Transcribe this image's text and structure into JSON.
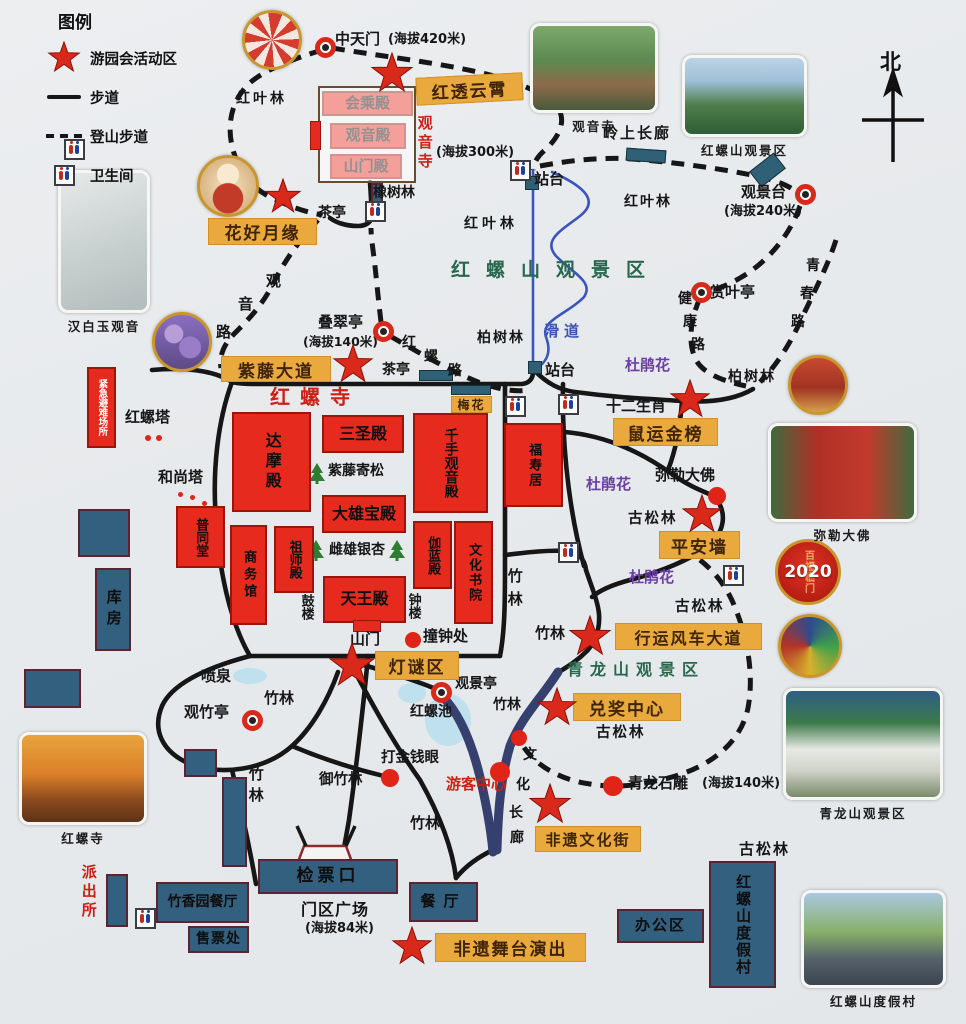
{
  "legend": {
    "title": "图例",
    "star_label": "游园会活动区",
    "walk_label": "步道",
    "trail_label": "登山步道",
    "toilet_label": "卫生间"
  },
  "compass": {
    "label": "北"
  },
  "badge": {
    "year": "2020",
    "motto": "百福临门"
  },
  "texts": [
    {
      "t": "中天门",
      "x": 335,
      "y": 32,
      "s": 15,
      "n": "label-zhongtianmen"
    },
    {
      "t": "(海拔420米)",
      "x": 388,
      "y": 33,
      "s": 13,
      "n": "label-elevation-420"
    },
    {
      "t": "红叶林",
      "x": 236,
      "y": 92,
      "sp": 3
    },
    {
      "t": "橡树林",
      "x": 373,
      "y": 186
    },
    {
      "t": "茶亭",
      "x": 318,
      "y": 206
    },
    {
      "t": "(海拔300米)",
      "x": 436,
      "y": 146,
      "s": 13,
      "n": "label-elevation-300"
    },
    {
      "t": "站台",
      "x": 534,
      "y": 172,
      "s": 15
    },
    {
      "t": "观音寺",
      "x": 416,
      "y": 115,
      "c": "red",
      "v": 1,
      "s": 15,
      "sp": 4,
      "n": "label-guanyin-temple"
    },
    {
      "t": "岭上长廊",
      "x": 603,
      "y": 126,
      "s": 15,
      "sp": 2,
      "n": "label-ridge-corridor"
    },
    {
      "t": "红叶林",
      "x": 624,
      "y": 195,
      "sp": 2
    },
    {
      "t": "红叶林",
      "x": 464,
      "y": 217,
      "sp": 4
    },
    {
      "t": "观景台",
      "x": 741,
      "y": 185,
      "s": 15,
      "n": "label-viewing-platform"
    },
    {
      "t": "(海拔240米)",
      "x": 724,
      "y": 205,
      "s": 13,
      "n": "label-elevation-240"
    },
    {
      "t": "赏叶亭",
      "x": 710,
      "y": 285,
      "s": 15
    },
    {
      "t": "健",
      "x": 678,
      "y": 292
    },
    {
      "t": "康",
      "x": 683,
      "y": 315
    },
    {
      "t": "路",
      "x": 691,
      "y": 338
    },
    {
      "t": "青",
      "x": 806,
      "y": 259
    },
    {
      "t": "春",
      "x": 800,
      "y": 287
    },
    {
      "t": "路",
      "x": 791,
      "y": 315
    },
    {
      "t": "柏树林",
      "x": 728,
      "y": 370,
      "sp": 2
    },
    {
      "t": "叠翠亭",
      "x": 318,
      "y": 315,
      "s": 15
    },
    {
      "t": "(海拔140米)",
      "x": 303,
      "y": 335,
      "s": 12.5,
      "n": "label-elevation-140"
    },
    {
      "t": "红",
      "x": 402,
      "y": 336
    },
    {
      "t": "螺",
      "x": 424,
      "y": 350
    },
    {
      "t": "路",
      "x": 448,
      "y": 364
    },
    {
      "t": "茶亭",
      "x": 382,
      "y": 363
    },
    {
      "t": "柏树林",
      "x": 477,
      "y": 331,
      "sp": 2
    },
    {
      "t": "站台",
      "x": 545,
      "y": 363,
      "s": 15
    },
    {
      "t": "滑道",
      "x": 544,
      "y": 324,
      "c": "blue",
      "s": 15,
      "sp": 5,
      "n": "label-slideway"
    },
    {
      "t": "红螺山观景区",
      "x": 451,
      "y": 261,
      "c": "green",
      "s": 19,
      "sp": 16,
      "n": "label-hongluoshan-scenic-area"
    },
    {
      "t": "杜鹃花",
      "x": 625,
      "y": 358,
      "c": "purple",
      "s": 15
    },
    {
      "t": "杜鹃花",
      "x": 586,
      "y": 477,
      "c": "purple",
      "s": 15
    },
    {
      "t": "杜鹃花",
      "x": 629,
      "y": 570,
      "c": "purple",
      "s": 15
    },
    {
      "t": "十二生肖",
      "x": 606,
      "y": 399,
      "s": 15,
      "n": "label-zodiac"
    },
    {
      "t": "弥勒大佛",
      "x": 655,
      "y": 468,
      "s": 15,
      "n": "label-maitreya"
    },
    {
      "t": "古松林",
      "x": 628,
      "y": 512,
      "s": 14.5,
      "sp": 2
    },
    {
      "t": "古松林",
      "x": 675,
      "y": 600,
      "s": 14.5,
      "sp": 2
    },
    {
      "t": "古松林",
      "x": 596,
      "y": 726,
      "s": 14.5,
      "sp": 2
    },
    {
      "t": "古松林",
      "x": 739,
      "y": 842,
      "s": 15,
      "sp": 2
    },
    {
      "t": "观",
      "x": 266,
      "y": 274,
      "s": 15
    },
    {
      "t": "音",
      "x": 238,
      "y": 297,
      "s": 15
    },
    {
      "t": "路",
      "x": 216,
      "y": 325,
      "s": 15
    },
    {
      "t": "红螺塔",
      "x": 125,
      "y": 410,
      "s": 15,
      "n": "label-hongluo-pagoda"
    },
    {
      "t": "和尚塔",
      "x": 158,
      "y": 470,
      "s": 15
    },
    {
      "t": "红螺寺",
      "x": 270,
      "y": 387,
      "c": "red",
      "s": 20,
      "sp": 10,
      "n": "label-hongluo-temple"
    },
    {
      "t": "竹林",
      "x": 506,
      "y": 568,
      "v": 1,
      "s": 15,
      "sp": 8
    },
    {
      "t": "竹林",
      "x": 535,
      "y": 626,
      "s": 15
    },
    {
      "t": "竹林",
      "x": 264,
      "y": 691,
      "s": 15
    },
    {
      "t": "竹林",
      "x": 247,
      "y": 766,
      "v": 1,
      "s": 15,
      "sp": 6
    },
    {
      "t": "竹林",
      "x": 410,
      "y": 816,
      "s": 15
    },
    {
      "t": "竹林",
      "x": 493,
      "y": 698,
      "s": 14
    },
    {
      "t": "喷泉",
      "x": 201,
      "y": 669,
      "s": 15
    },
    {
      "t": "观竹亭",
      "x": 184,
      "y": 705,
      "s": 15
    },
    {
      "t": "观景亭",
      "x": 455,
      "y": 677,
      "s": 14
    },
    {
      "t": "红螺池",
      "x": 410,
      "y": 705,
      "s": 14
    },
    {
      "t": "打金钱眼",
      "x": 381,
      "y": 751,
      "s": 14.5
    },
    {
      "t": "御竹林",
      "x": 319,
      "y": 773,
      "s": 14.5
    },
    {
      "t": "游客中心",
      "x": 446,
      "y": 777,
      "c": "red",
      "s": 15,
      "n": "label-visitor-center"
    },
    {
      "t": "文",
      "x": 523,
      "y": 748
    },
    {
      "t": "化",
      "x": 516,
      "y": 778
    },
    {
      "t": "长",
      "x": 509,
      "y": 806
    },
    {
      "t": "廊",
      "x": 510,
      "y": 831
    },
    {
      "t": "青龙山观景区",
      "x": 567,
      "y": 662,
      "c": "green",
      "s": 16,
      "sp": 7,
      "n": "label-qinglongshan-scenic-area"
    },
    {
      "t": "青龙石雕",
      "x": 628,
      "y": 776,
      "s": 15,
      "n": "label-dragon-sculpture"
    },
    {
      "t": "(海拔140米)",
      "x": 702,
      "y": 777,
      "s": 13
    },
    {
      "t": "撞钟处",
      "x": 423,
      "y": 629,
      "s": 15
    },
    {
      "t": "山门",
      "x": 350,
      "y": 632,
      "s": 15
    },
    {
      "t": "鼓楼",
      "x": 299,
      "y": 594,
      "v": 1,
      "s": 13
    },
    {
      "t": "钟楼",
      "x": 406,
      "y": 593,
      "v": 1,
      "s": 13
    },
    {
      "t": "紫藤寄松",
      "x": 328,
      "y": 464,
      "s": 14
    },
    {
      "t": "雌雄银杏",
      "x": 329,
      "y": 543,
      "s": 14
    },
    {
      "t": "门区广场",
      "x": 301,
      "y": 902,
      "s": 16,
      "sp": 1,
      "n": "label-gate-plaza"
    },
    {
      "t": "(海拔84米)",
      "x": 305,
      "y": 922,
      "s": 13,
      "n": "label-elevation-84"
    },
    {
      "t": "派出所",
      "x": 80,
      "y": 864,
      "c": "red",
      "v": 1,
      "s": 15,
      "sp": 4,
      "n": "label-police-station"
    },
    {
      "t": "办公区",
      "x": 0,
      "y": -999,
      "s": 1
    }
  ],
  "yellow_labels": [
    {
      "t": "红透云霄",
      "x": 416,
      "y": 75,
      "w": 107,
      "h": 28,
      "s": 17,
      "r": -3
    },
    {
      "t": "花好月缘",
      "x": 208,
      "y": 218,
      "w": 109,
      "h": 27,
      "s": 17
    },
    {
      "t": "紫藤大道",
      "x": 221,
      "y": 356,
      "w": 110,
      "h": 26,
      "s": 17
    },
    {
      "t": "梅花",
      "x": 451,
      "y": 396,
      "w": 41,
      "h": 17,
      "s": 12
    },
    {
      "t": "鼠运金榜",
      "x": 613,
      "y": 418,
      "w": 105,
      "h": 28,
      "s": 17
    },
    {
      "t": "平安墙",
      "x": 659,
      "y": 531,
      "w": 81,
      "h": 28,
      "s": 17
    },
    {
      "t": "行运风车大道",
      "x": 615,
      "y": 623,
      "w": 147,
      "h": 27,
      "s": 16
    },
    {
      "t": "兑奖中心",
      "x": 573,
      "y": 693,
      "w": 108,
      "h": 28,
      "s": 17
    },
    {
      "t": "灯谜区",
      "x": 375,
      "y": 651,
      "w": 84,
      "h": 29,
      "s": 17
    },
    {
      "t": "非遗文化街",
      "x": 535,
      "y": 826,
      "w": 106,
      "h": 26,
      "s": 15
    },
    {
      "t": "非遗舞台演出",
      "x": 435,
      "y": 933,
      "w": 151,
      "h": 29,
      "s": 17
    }
  ],
  "red_buildings": [
    {
      "t": "会乘殿",
      "x": 322,
      "y": 91,
      "w": 91,
      "h": 25,
      "s": 15
    },
    {
      "t": "观音殿",
      "x": 330,
      "y": 123,
      "w": 76,
      "h": 26,
      "s": 15
    },
    {
      "t": "山门殿",
      "x": 330,
      "y": 154,
      "w": 72,
      "h": 25,
      "s": 15
    },
    {
      "t": "达摩殿",
      "x": 232,
      "y": 412,
      "w": 79,
      "h": 100,
      "v": 1,
      "s": 16,
      "sp": 4
    },
    {
      "t": "三圣殿",
      "x": 322,
      "y": 415,
      "w": 82,
      "h": 38,
      "s": 16
    },
    {
      "t": "千手观音殿",
      "x": 413,
      "y": 413,
      "w": 75,
      "h": 100,
      "v": 1,
      "s": 14
    },
    {
      "t": "大雄宝殿",
      "x": 322,
      "y": 495,
      "w": 84,
      "h": 38,
      "s": 16
    },
    {
      "t": "祖师殿",
      "x": 274,
      "y": 526,
      "w": 40,
      "h": 67,
      "v": 1,
      "s": 13
    },
    {
      "t": "伽蓝殿",
      "x": 413,
      "y": 521,
      "w": 39,
      "h": 68,
      "v": 1,
      "s": 13
    },
    {
      "t": "文化书院",
      "x": 454,
      "y": 521,
      "w": 39,
      "h": 103,
      "v": 1,
      "s": 13,
      "sp": 2
    },
    {
      "t": "商务馆",
      "x": 230,
      "y": 525,
      "w": 37,
      "h": 100,
      "v": 1,
      "s": 13,
      "sp": 4
    },
    {
      "t": "天王殿",
      "x": 323,
      "y": 576,
      "w": 83,
      "h": 47,
      "s": 16
    },
    {
      "t": "福寿居",
      "x": 504,
      "y": 423,
      "w": 59,
      "h": 84,
      "v": 1,
      "s": 13,
      "sp": 2
    },
    {
      "t": "普同堂",
      "x": 176,
      "y": 506,
      "w": 49,
      "h": 62,
      "v": 1,
      "s": 13
    },
    {
      "t": "紧急避难场所",
      "x": 87,
      "y": 367,
      "w": 29,
      "h": 81,
      "v": 1,
      "s": 9.5,
      "wt": 1
    }
  ],
  "navy_buildings": [
    {
      "t": "检票口",
      "x": 258,
      "y": 859,
      "w": 140,
      "h": 35,
      "s": 17,
      "sp": 4
    },
    {
      "t": "竹香园餐厅",
      "x": 156,
      "y": 882,
      "w": 93,
      "h": 41,
      "s": 14
    },
    {
      "t": "售票处",
      "x": 188,
      "y": 926,
      "w": 61,
      "h": 27,
      "s": 14,
      "sp": 1
    },
    {
      "t": "餐厅",
      "x": 409,
      "y": 882,
      "w": 69,
      "h": 40,
      "s": 15,
      "sp": 8
    },
    {
      "t": "办公区",
      "x": 617,
      "y": 909,
      "w": 87,
      "h": 34,
      "s": 15,
      "sp": 2
    },
    {
      "t": "红螺山度假村",
      "x": 709,
      "y": 861,
      "w": 67,
      "h": 127,
      "v": 1,
      "s": 15,
      "sp": 2
    },
    {
      "t": "库房",
      "x": 95,
      "y": 568,
      "w": 36,
      "h": 83,
      "v": 1,
      "s": 15,
      "sp": 6
    },
    {
      "t": "",
      "x": 78,
      "y": 509,
      "w": 52,
      "h": 48
    },
    {
      "t": "",
      "x": 24,
      "y": 669,
      "w": 57,
      "h": 39
    },
    {
      "t": "",
      "x": 184,
      "y": 749,
      "w": 33,
      "h": 28
    },
    {
      "t": "",
      "x": 222,
      "y": 777,
      "w": 25,
      "h": 90
    },
    {
      "t": "",
      "x": 106,
      "y": 874,
      "w": 22,
      "h": 53
    },
    {
      "t": "",
      "x": 371,
      "y": 183,
      "w": 12,
      "h": 27
    }
  ],
  "deco_rects": [
    {
      "x": 318,
      "y": 86,
      "w": 98,
      "h": 97,
      "k": "outline"
    },
    {
      "x": 310,
      "y": 121,
      "w": 11,
      "h": 29,
      "k": "redfill"
    },
    {
      "x": 353,
      "y": 620,
      "w": 28,
      "h": 12,
      "k": "redfill"
    },
    {
      "x": 626,
      "y": 149,
      "w": 40,
      "h": 13,
      "k": "teal",
      "r": 4
    },
    {
      "x": 752,
      "y": 160,
      "w": 31,
      "h": 20,
      "k": "teal",
      "r": -38
    },
    {
      "x": 419,
      "y": 370,
      "w": 34,
      "h": 11,
      "k": "teal"
    },
    {
      "x": 451,
      "y": 385,
      "w": 40,
      "h": 10,
      "k": "teal"
    },
    {
      "x": 525,
      "y": 176,
      "w": 14,
      "h": 14,
      "k": "teal"
    },
    {
      "x": 528,
      "y": 361,
      "w": 14,
      "h": 13,
      "k": "teal"
    }
  ],
  "stars": [
    {
      "x": 392,
      "y": 74,
      "s": 44
    },
    {
      "x": 283,
      "y": 197,
      "s": 38
    },
    {
      "x": 353,
      "y": 365,
      "s": 42
    },
    {
      "x": 352,
      "y": 666,
      "s": 48
    },
    {
      "x": 690,
      "y": 400,
      "s": 42
    },
    {
      "x": 702,
      "y": 515,
      "s": 42
    },
    {
      "x": 590,
      "y": 637,
      "s": 44
    },
    {
      "x": 557,
      "y": 708,
      "s": 42
    },
    {
      "x": 550,
      "y": 805,
      "s": 44
    },
    {
      "x": 412,
      "y": 947,
      "s": 42
    }
  ],
  "dots": [
    {
      "x": 413,
      "y": 640,
      "r": 8
    },
    {
      "x": 717,
      "y": 496,
      "r": 9
    },
    {
      "x": 390,
      "y": 778,
      "r": 9
    },
    {
      "x": 500,
      "y": 772,
      "r": 10
    },
    {
      "x": 519,
      "y": 738,
      "r": 8
    },
    {
      "x": 613,
      "y": 786,
      "r": 10
    },
    {
      "x": 148,
      "y": 438,
      "r": 3
    },
    {
      "x": 159,
      "y": 438,
      "r": 3
    },
    {
      "x": 180,
      "y": 494,
      "r": 2.5
    },
    {
      "x": 192,
      "y": 497,
      "r": 2.5
    },
    {
      "x": 204,
      "y": 503,
      "r": 2.5
    }
  ],
  "rings": [
    {
      "x": 325,
      "y": 47
    },
    {
      "x": 383,
      "y": 331
    },
    {
      "x": 805,
      "y": 194
    },
    {
      "x": 701,
      "y": 292
    },
    {
      "x": 252,
      "y": 720
    },
    {
      "x": 441,
      "y": 692
    }
  ],
  "toilets": [
    {
      "x": 74,
      "y": 149
    },
    {
      "x": 375,
      "y": 211
    },
    {
      "x": 520,
      "y": 170
    },
    {
      "x": 515,
      "y": 406
    },
    {
      "x": 568,
      "y": 404
    },
    {
      "x": 568,
      "y": 552
    },
    {
      "x": 733,
      "y": 575
    },
    {
      "x": 145,
      "y": 918
    }
  ],
  "photos": [
    {
      "shape": "circle",
      "x": 272,
      "y": 40,
      "r": 30,
      "kind": "festival",
      "n": "photo-festival"
    },
    {
      "shape": "circle",
      "x": 228,
      "y": 186,
      "r": 31,
      "kind": "yuelao",
      "n": "photo-matchmaker"
    },
    {
      "shape": "circle",
      "x": 182,
      "y": 342,
      "r": 30,
      "kind": "wisteria",
      "n": "photo-wisteria"
    },
    {
      "shape": "rect",
      "x": 58,
      "y": 170,
      "w": 92,
      "h": 143,
      "kind": "guanyin",
      "cap": "汉白玉观音",
      "n": "photo-guanyin-statue"
    },
    {
      "shape": "rect",
      "x": 19,
      "y": 732,
      "w": 128,
      "h": 93,
      "kind": "autumn",
      "cap": "红螺寺",
      "n": "photo-hongluo-temple"
    },
    {
      "shape": "rect",
      "x": 530,
      "y": 23,
      "w": 128,
      "h": 90,
      "kind": "temple",
      "cap": "观音寺",
      "n": "photo-guanyin-temple"
    },
    {
      "shape": "rect",
      "x": 682,
      "y": 55,
      "w": 125,
      "h": 82,
      "kind": "mountain",
      "cap": "红螺山观景区",
      "n": "photo-hongluoshan"
    },
    {
      "shape": "circle",
      "x": 818,
      "y": 385,
      "r": 30,
      "kind": "shrine",
      "n": "photo-shrine"
    },
    {
      "shape": "rect",
      "x": 768,
      "y": 423,
      "w": 149,
      "h": 99,
      "kind": "buddha",
      "cap": "弥勒大佛",
      "n": "photo-maitreya"
    },
    {
      "shape": "circle",
      "x": 810,
      "y": 646,
      "r": 32,
      "kind": "windmill",
      "n": "photo-windmills"
    },
    {
      "shape": "rect",
      "x": 783,
      "y": 688,
      "w": 160,
      "h": 112,
      "kind": "dragon",
      "cap": "青龙山观景区",
      "n": "photo-qinglongshan"
    },
    {
      "shape": "rect",
      "x": 801,
      "y": 890,
      "w": 145,
      "h": 98,
      "kind": "resort",
      "cap": "红螺山度假村",
      "n": "photo-resort"
    }
  ],
  "trees": [
    {
      "x": 317,
      "y": 473
    },
    {
      "x": 316,
      "y": 550
    },
    {
      "x": 397,
      "y": 550
    }
  ]
}
